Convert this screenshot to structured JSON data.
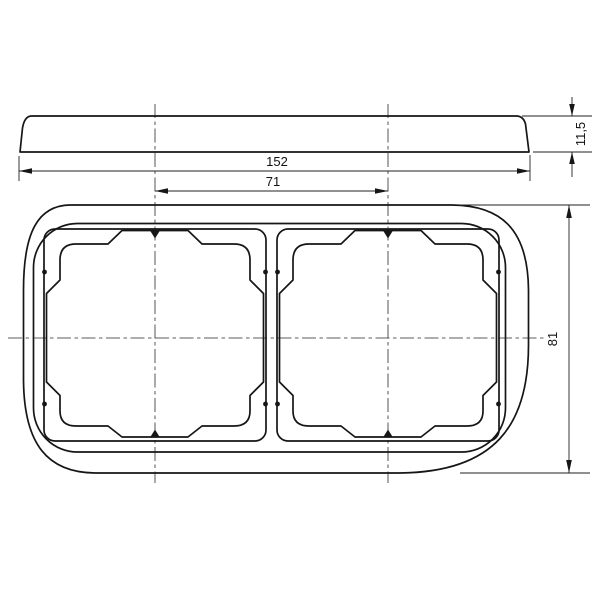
{
  "drawing": {
    "dimensions": {
      "overall_width": "152",
      "center_spacing": "71",
      "depth": "11,5",
      "overall_height": "81"
    }
  }
}
